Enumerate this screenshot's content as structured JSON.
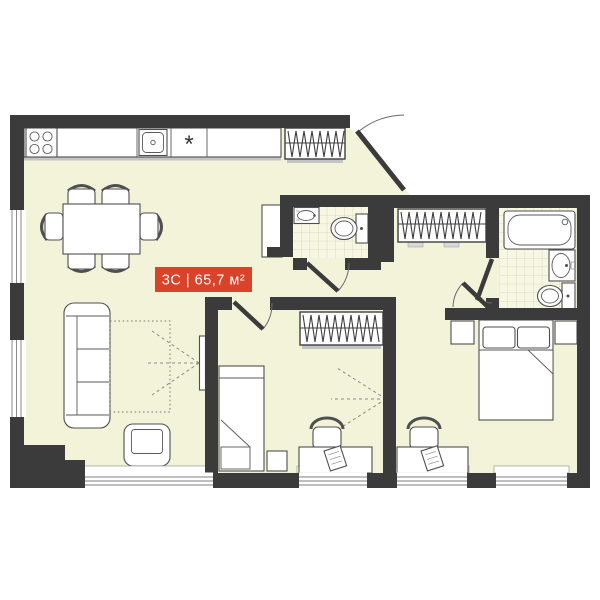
{
  "badge": {
    "label": "3С | 65,7 м²"
  },
  "kitchen": {
    "fridge_symbol": "*"
  },
  "colors": {
    "wall": "#3b3b3b",
    "floor": "#f2f3d9",
    "tile": "#f7f7e3",
    "tile_line": "#dadbbc",
    "badge_bg": "#d9432a",
    "badge_text": "#ffffff",
    "furniture_outline": "#4f4f4f"
  }
}
